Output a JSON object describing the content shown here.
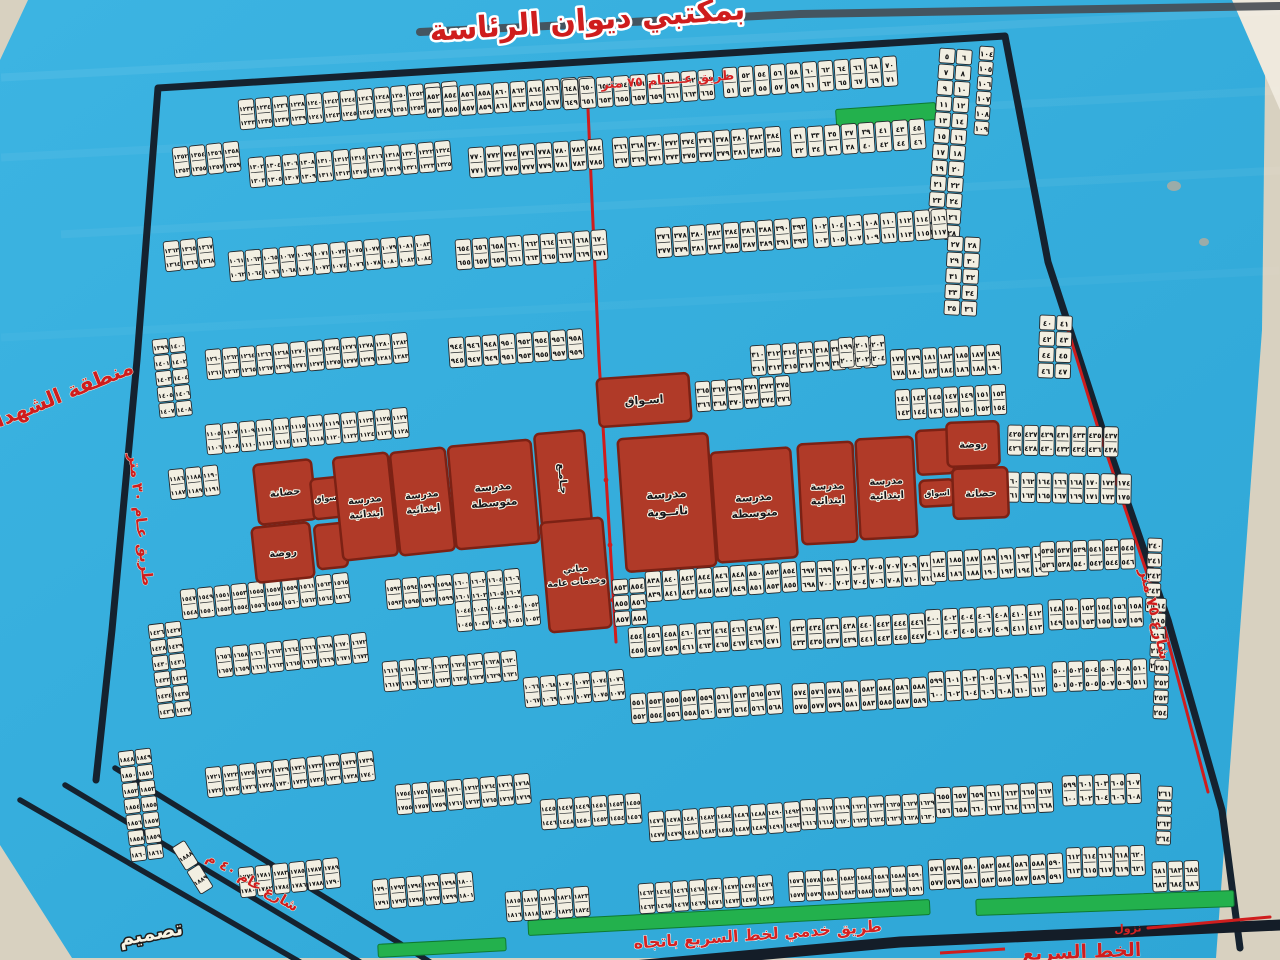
{
  "title": "بمكتبي ديوان الرئاسة",
  "colors": {
    "photo_bg": "#d8d1c0",
    "photo_corner": "#efe9dd",
    "poster_blue": "#2ea6d6",
    "poster_blue_light": "#3cb4e2",
    "map_border": "#15222f",
    "road_red": "#cf1d1d",
    "green_strip": "#23b14d",
    "plot_cell": "#f2efe2",
    "plot_edge": "#23282c",
    "facility_fill": "#b03a28",
    "facility_edge": "#7c2114",
    "expressway_black": "#141d28",
    "poster_top_line": "#464b52"
  },
  "labels": [
    {
      "name": "poster-title",
      "text": "بمكتبي ديوان الرئاسة",
      "x": 588,
      "y": 30,
      "rot": -4,
      "size": 30,
      "fill": "#cf1d1d",
      "stroke": "#ffffff",
      "sw": 5,
      "weight": "bold"
    },
    {
      "name": "road-75m-top-label",
      "text": "طريق عـــــام ٧٥ متر",
      "x": 668,
      "y": 84,
      "rot": -4,
      "size": 13,
      "fill": "#d42222",
      "stroke": "#ffffff",
      "sw": 0.6,
      "weight": "bold"
    },
    {
      "name": "martyrs-district-label",
      "text": "منطقة الشهداء",
      "x": 62,
      "y": 402,
      "rot": -22,
      "size": 21,
      "fill": "#cf1d1d",
      "stroke": "#f3ecdc",
      "sw": 1,
      "weight": "bold"
    },
    {
      "name": "road-30m-left-label",
      "text": "طريق عـام ٣٠ متر",
      "x": 136,
      "y": 520,
      "rot": 84,
      "size": 15,
      "fill": "#cf1d1d",
      "stroke": "#f3ecdc",
      "sw": 0.8,
      "weight": "bold"
    },
    {
      "name": "street-75m-right-label",
      "text": "شارع ٧٥ متر",
      "x": 1150,
      "y": 615,
      "rot": 77,
      "size": 15,
      "fill": "#cf1d1d",
      "stroke": "#f3ecdc",
      "sw": 0.8,
      "weight": "bold"
    },
    {
      "name": "street-40m-label",
      "text": "شارع عام ٤٠ م",
      "x": 250,
      "y": 886,
      "rot": 30,
      "size": 14,
      "fill": "#cf1d1d",
      "stroke": "#f3ecdc",
      "sw": 1,
      "weight": "bold"
    },
    {
      "name": "service-road-label",
      "text": "طريق خدمي لخط السريع باتجاه",
      "x": 758,
      "y": 940,
      "rot": -4,
      "size": 16,
      "fill": "#d42222",
      "stroke": "#ffffff",
      "sw": 1,
      "weight": "bold"
    },
    {
      "name": "expressway-label",
      "text": "الخط السريع",
      "x": 1082,
      "y": 958,
      "rot": -2,
      "size": 19,
      "fill": "#cf1d1d",
      "stroke": "#ffffff",
      "sw": 0.5,
      "weight": "bold"
    },
    {
      "name": "exit-ramp-label",
      "text": "نزول",
      "x": 1128,
      "y": 932,
      "rot": -2,
      "size": 11,
      "fill": "#d42222",
      "stroke": "none",
      "sw": 0,
      "weight": "bold"
    },
    {
      "name": "design-credit-label",
      "text": "تصميم",
      "x": 152,
      "y": 940,
      "rot": -10,
      "size": 20,
      "fill": "#f7f3e4",
      "stroke": "#1c1c1c",
      "sw": 3,
      "weight": "bold"
    }
  ],
  "facilities": [
    {
      "name": "nursery-left",
      "label": "حضانة",
      "x": 256,
      "y": 462,
      "w": 58,
      "h": 60,
      "rot": -6,
      "fs": 10
    },
    {
      "name": "kindergarten-left",
      "label": "روضة",
      "x": 254,
      "y": 525,
      "w": 58,
      "h": 55,
      "rot": -6,
      "fs": 10
    },
    {
      "name": "market-left",
      "label": "اسواق",
      "x": 312,
      "y": 478,
      "w": 30,
      "h": 40,
      "rot": -6,
      "fs": 8
    },
    {
      "name": "reserved-block-left",
      "label": "",
      "x": 316,
      "y": 524,
      "w": 30,
      "h": 44,
      "rot": -6,
      "fs": 8
    },
    {
      "name": "primary-school-1",
      "label": "مدرسة\nابتدائية",
      "x": 338,
      "y": 455,
      "w": 55,
      "h": 103,
      "rot": -6,
      "fs": 10
    },
    {
      "name": "primary-school-2",
      "label": "مدرسة\nابتدائية",
      "x": 395,
      "y": 450,
      "w": 55,
      "h": 103,
      "rot": -6,
      "fs": 10
    },
    {
      "name": "middle-school-1",
      "label": "مدرسة\nمتوسطة",
      "x": 452,
      "y": 443,
      "w": 83,
      "h": 103,
      "rot": -5,
      "fs": 11
    },
    {
      "name": "mosque-block",
      "label": "جـامـع",
      "x": 538,
      "y": 432,
      "w": 50,
      "h": 93,
      "rot": -5,
      "fs": 10,
      "trot": 90
    },
    {
      "name": "public-services-block",
      "label": "مباني\nوخدمات عامة",
      "x": 545,
      "y": 520,
      "w": 62,
      "h": 110,
      "rot": -5,
      "fs": 9
    },
    {
      "name": "market-center",
      "label": "اسـواق",
      "x": 598,
      "y": 376,
      "w": 92,
      "h": 48,
      "rot": -4,
      "fs": 11
    },
    {
      "name": "secondary-school",
      "label": "مدرسة\nثانــوية",
      "x": 622,
      "y": 436,
      "w": 90,
      "h": 133,
      "rot": -4,
      "fs": 12
    },
    {
      "name": "middle-school-2",
      "label": "مدرسة\nمتوسطة",
      "x": 714,
      "y": 450,
      "w": 80,
      "h": 110,
      "rot": -4,
      "fs": 11
    },
    {
      "name": "primary-school-3",
      "label": "مدرسة\nابتدائية",
      "x": 800,
      "y": 443,
      "w": 55,
      "h": 100,
      "rot": -3,
      "fs": 10
    },
    {
      "name": "primary-school-4",
      "label": "مدرسة\nابتدائية",
      "x": 858,
      "y": 438,
      "w": 57,
      "h": 100,
      "rot": -3,
      "fs": 10
    },
    {
      "name": "reserved-block-right",
      "label": "",
      "x": 917,
      "y": 430,
      "w": 36,
      "h": 44,
      "rot": -3,
      "fs": 8
    },
    {
      "name": "market-right",
      "label": "اسواق",
      "x": 920,
      "y": 480,
      "w": 34,
      "h": 26,
      "rot": -3,
      "fs": 8
    },
    {
      "name": "kindergarten-right",
      "label": "روضة",
      "x": 947,
      "y": 422,
      "w": 52,
      "h": 44,
      "rot": -2,
      "fs": 10
    },
    {
      "name": "nursery-right",
      "label": "حضانة",
      "x": 953,
      "y": 468,
      "w": 55,
      "h": 50,
      "rot": -2,
      "fs": 10
    }
  ],
  "green_strips": [
    {
      "x": 836,
      "y": 106,
      "w": 100,
      "h": 17,
      "rot": -4
    },
    {
      "x": 378,
      "y": 941,
      "w": 128,
      "h": 13,
      "rot": -3
    },
    {
      "x": 528,
      "y": 910,
      "w": 402,
      "h": 15,
      "rot": -3
    },
    {
      "x": 976,
      "y": 895,
      "w": 258,
      "h": 16,
      "rot": -2
    }
  ],
  "roads": {
    "map_border": [
      [
        96,
        780
      ],
      [
        112,
        630
      ],
      [
        137,
        360
      ],
      [
        158,
        88
      ],
      [
        1005,
        36
      ],
      [
        1048,
        262
      ],
      [
        1102,
        428
      ],
      [
        1168,
        620
      ],
      [
        1222,
        810
      ],
      [
        1240,
        948
      ]
    ],
    "poster_top_line": [
      [
        420,
        32
      ],
      [
        800,
        14
      ],
      [
        1280,
        6
      ]
    ],
    "expressway": [
      [
        500,
        978
      ],
      [
        900,
        942
      ],
      [
        1280,
        925
      ]
    ],
    "expressway_dash": [
      [
        940,
        953
      ],
      [
        1005,
        949
      ]
    ],
    "corner_roads": [
      [
        [
          20,
          800
        ],
        [
          300,
          962
        ]
      ],
      [
        [
          65,
          785
        ],
        [
          360,
          962
        ]
      ],
      [
        [
          115,
          768
        ],
        [
          430,
          962
        ]
      ]
    ],
    "red_lines": [
      [
        [
          1068,
          330
        ],
        [
          1098,
          428
        ],
        [
          1162,
          618
        ],
        [
          1208,
          792
        ]
      ],
      [
        [
          587,
          86
        ],
        [
          599,
          360
        ],
        [
          616,
          642
        ]
      ],
      [
        [
          1148,
          928
        ],
        [
          1270,
          917
        ]
      ]
    ],
    "red_dots": [
      [
        606,
        480
      ],
      [
        610,
        545
      ],
      [
        613,
        600
      ]
    ]
  },
  "plot_strips": [
    [
      238,
      100,
      13,
      2,
      17,
      30,
      -5,
      1232
    ],
    [
      425,
      88,
      10,
      2,
      17,
      30,
      -4,
      852
    ],
    [
      562,
      80,
      9,
      2,
      17,
      30,
      -4,
      648
    ],
    [
      722,
      68,
      11,
      2,
      16,
      30,
      -4,
      50
    ],
    [
      940,
      48,
      2,
      12,
      17,
      16,
      4,
      5
    ],
    [
      980,
      46,
      1,
      6,
      16,
      15,
      4,
      104
    ],
    [
      172,
      148,
      4,
      2,
      17,
      30,
      -6,
      1352
    ],
    [
      248,
      158,
      12,
      2,
      17,
      30,
      -5,
      1302
    ],
    [
      468,
      148,
      8,
      2,
      17,
      30,
      -4,
      770
    ],
    [
      612,
      138,
      10,
      2,
      17,
      30,
      -4,
      366
    ],
    [
      790,
      128,
      8,
      2,
      17,
      30,
      -4,
      31
    ],
    [
      163,
      242,
      3,
      2,
      17,
      30,
      -6,
      1363
    ],
    [
      228,
      252,
      12,
      2,
      17,
      30,
      -5,
      1061
    ],
    [
      455,
      240,
      9,
      2,
      17,
      30,
      -4,
      654
    ],
    [
      655,
      228,
      9,
      2,
      17,
      30,
      -4,
      376
    ],
    [
      812,
      218,
      8,
      2,
      17,
      30,
      -4,
      102
    ],
    [
      948,
      236,
      2,
      5,
      17,
      16,
      3,
      27
    ],
    [
      152,
      340,
      2,
      5,
      17,
      16,
      -6,
      1399
    ],
    [
      205,
      350,
      12,
      2,
      17,
      30,
      -5,
      1260
    ],
    [
      448,
      338,
      8,
      2,
      17,
      30,
      -4,
      944
    ],
    [
      695,
      382,
      6,
      2,
      16,
      30,
      -4,
      365
    ],
    [
      750,
      346,
      8,
      2,
      16,
      30,
      -4,
      310
    ],
    [
      838,
      338,
      3,
      2,
      16,
      30,
      -4,
      199
    ],
    [
      890,
      350,
      7,
      2,
      16,
      30,
      -3,
      177
    ],
    [
      895,
      390,
      7,
      2,
      16,
      30,
      -3,
      141
    ],
    [
      1040,
      315,
      2,
      4,
      17,
      16,
      2,
      40
    ],
    [
      1008,
      425,
      7,
      2,
      16,
      30,
      1,
      425
    ],
    [
      1005,
      472,
      8,
      2,
      16,
      30,
      1,
      160
    ],
    [
      612,
      580,
      2,
      3,
      17,
      16,
      -4,
      853
    ],
    [
      645,
      572,
      9,
      2,
      17,
      30,
      -4,
      838
    ],
    [
      800,
      562,
      8,
      2,
      17,
      30,
      -3,
      697
    ],
    [
      930,
      552,
      7,
      2,
      17,
      30,
      -3,
      183
    ],
    [
      1040,
      542,
      6,
      2,
      16,
      30,
      -2,
      535
    ],
    [
      1148,
      538,
      1,
      5,
      16,
      15,
      2,
      240
    ],
    [
      205,
      425,
      12,
      2,
      17,
      30,
      -5,
      1105
    ],
    [
      168,
      470,
      3,
      2,
      17,
      30,
      -6,
      1186
    ],
    [
      180,
      590,
      10,
      2,
      17,
      30,
      -6,
      1547
    ],
    [
      385,
      580,
      8,
      2,
      17,
      30,
      -5,
      1592
    ],
    [
      455,
      602,
      5,
      2,
      17,
      30,
      -5,
      1044
    ],
    [
      628,
      628,
      9,
      2,
      17,
      30,
      -4,
      454
    ],
    [
      790,
      620,
      8,
      2,
      17,
      30,
      -3,
      432
    ],
    [
      925,
      610,
      7,
      2,
      17,
      30,
      -3,
      400
    ],
    [
      1048,
      600,
      6,
      2,
      16,
      30,
      -2,
      148
    ],
    [
      1152,
      598,
      1,
      5,
      16,
      15,
      2,
      214
    ],
    [
      148,
      625,
      2,
      6,
      17,
      16,
      -7,
      1426
    ],
    [
      215,
      648,
      9,
      2,
      17,
      30,
      -6,
      1656
    ],
    [
      382,
      662,
      8,
      2,
      17,
      30,
      -5,
      1616
    ],
    [
      523,
      678,
      6,
      2,
      17,
      30,
      -5,
      1066
    ],
    [
      630,
      694,
      9,
      2,
      17,
      30,
      -4,
      551
    ],
    [
      792,
      684,
      8,
      2,
      17,
      30,
      -3,
      574
    ],
    [
      928,
      672,
      7,
      2,
      17,
      30,
      -3,
      599
    ],
    [
      1052,
      662,
      6,
      2,
      16,
      30,
      -2,
      500
    ],
    [
      1155,
      660,
      1,
      4,
      16,
      15,
      2,
      251
    ],
    [
      118,
      752,
      2,
      7,
      17,
      16,
      -7,
      1848
    ],
    [
      205,
      768,
      10,
      2,
      17,
      30,
      -6,
      1721
    ],
    [
      395,
      785,
      8,
      2,
      17,
      30,
      -5,
      1754
    ],
    [
      540,
      800,
      6,
      2,
      17,
      30,
      -4,
      1445
    ],
    [
      648,
      812,
      9,
      2,
      17,
      30,
      -4,
      1476
    ],
    [
      800,
      800,
      8,
      2,
      17,
      30,
      -3,
      1615
    ],
    [
      935,
      788,
      7,
      2,
      17,
      30,
      -3,
      655
    ],
    [
      1062,
      776,
      5,
      2,
      16,
      30,
      -2,
      599
    ],
    [
      1158,
      786,
      1,
      4,
      16,
      15,
      2,
      261
    ],
    [
      238,
      868,
      6,
      2,
      17,
      30,
      -6,
      1779
    ],
    [
      372,
      880,
      6,
      2,
      17,
      30,
      -5,
      1790
    ],
    [
      505,
      892,
      5,
      2,
      17,
      30,
      -4,
      1815
    ],
    [
      638,
      884,
      8,
      2,
      17,
      30,
      -4,
      1462
    ],
    [
      788,
      872,
      8,
      2,
      17,
      30,
      -3,
      1576
    ],
    [
      928,
      860,
      8,
      2,
      17,
      30,
      -3,
      576
    ],
    [
      1066,
      848,
      5,
      2,
      16,
      30,
      -2,
      612
    ],
    [
      1152,
      862,
      3,
      2,
      16,
      30,
      -2,
      681
    ],
    [
      172,
      848,
      1,
      2,
      16,
      28,
      -32,
      1888
    ]
  ]
}
